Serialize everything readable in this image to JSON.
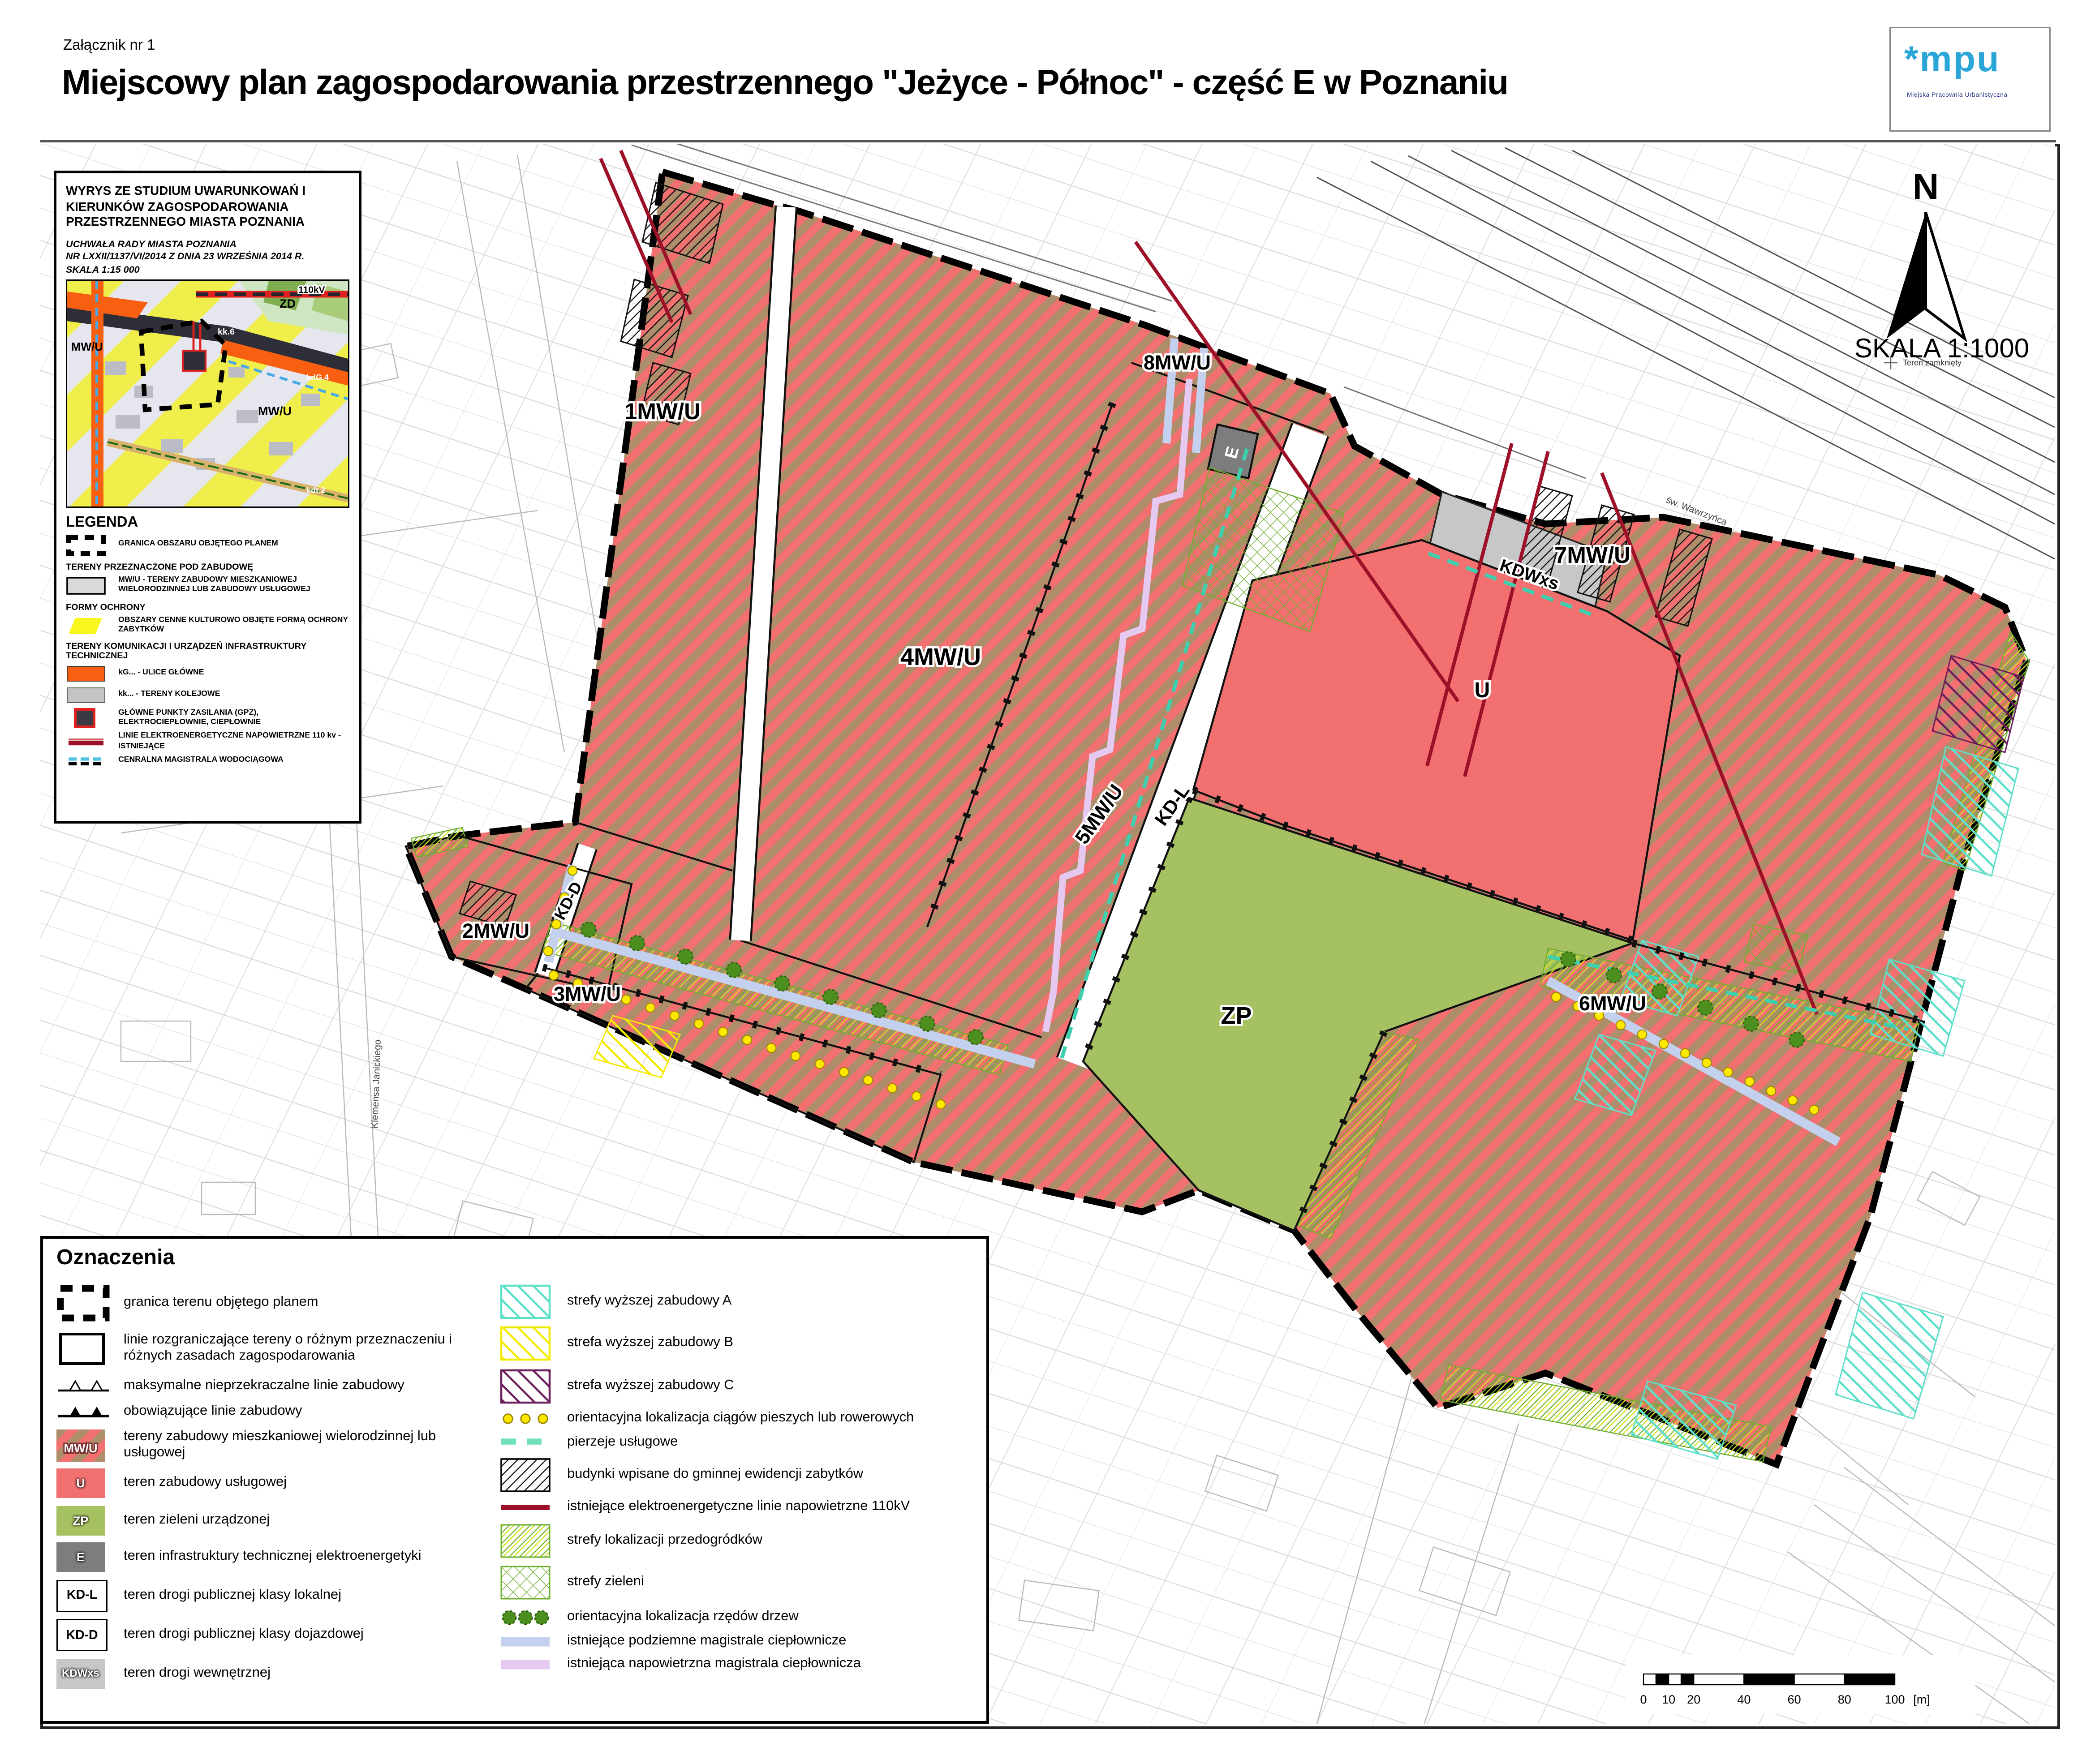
{
  "header": {
    "attachment": "Załącznik nr 1",
    "title": "Miejscowy plan zagospodarowania przestrzennego \"Jeżyce - Północ\" - część E  w Poznaniu",
    "logo": {
      "mark": "mpu",
      "star": "*",
      "subtitle": "Miejska Pracownia Urbanistyczna"
    }
  },
  "study_box": {
    "title": "WYRYS ZE STUDIUM UWARUNKOWAŃ I KIERUNKÓW  ZAGOSPODAROWANIA PRZESTRZENNEGO MIASTA POZNANIA",
    "res1": "UCHWAŁA RADY MIASTA POZNANIA",
    "res2": "NR LXXII/1137/VI/2014 Z DNIA 23 WRZEŚNIA 2014 R.",
    "res3": "SKALA 1:15 000",
    "legend_title": "LEGENDA",
    "e_granica": "GRANICA OBSZARU OBJĘTEGO PLANEM",
    "sec1": "TERENY PRZEZNACZONE POD ZABUDOWĘ",
    "e_mwu": "MW/U - TERENY ZABUDOWY MIESZKANIOWEJ WIELORODZINNEJ LUB ZABUDOWY USŁUGOWEJ",
    "sec2": "FORMY OCHRONY",
    "e_obszary": "OBSZARY CENNE KULTUROWO OBJĘTE FORMĄ OCHRONY ZABYTKÓW",
    "sec3": "TERENY KOMUNIKACJI I URZĄDZEŃ INFRASTRUKTURY TECHNICZNEJ",
    "e_kg": "kG...    - ULICE GŁÓWNE",
    "e_kk": "kk... - TERENY KOLEJOWE",
    "e_gpz": "GŁÓWNE PUNKTY ZASILANIA (GPZ), ELEKTROCIEPŁOWNIE, CIEPŁOWNIE",
    "e_linie": "LINIE  ELEKTROENERGETYCZNE NAPOWIETRZNE 110 kv - ISTNIEJĄCE",
    "e_magistrala": "CENRALNA MAGISTRALA WODOCIĄGOWA",
    "minimap": {
      "mwu_left": "MW/U",
      "mwu_right": "MW/U",
      "zd": "ZD",
      "kv": "110kV",
      "kk": "kk.6",
      "kdg": "kdG.4",
      "kdt": "kdt.2"
    }
  },
  "compass": {
    "letter": "N",
    "scale": "SKALA 1:1000",
    "teren": "Teren zamknięty"
  },
  "map": {
    "zones": {
      "z1": "1MW/U",
      "z2": "2MW/U",
      "z3": "3MW/U",
      "z4": "4MW/U",
      "z5": "5MW/U",
      "z6": "6MW/U",
      "z7": "7MW/U",
      "z8": "8MW/U",
      "u": "U",
      "zp": "ZP",
      "e": "E",
      "kdl": "KD-L",
      "kdd": "KD-D",
      "kdwxs": "KDWxs"
    },
    "bg_labels": {
      "street_top": "św. Wawrzyńca",
      "street_left": "Klemensa Janickiego"
    }
  },
  "oznaczenia": {
    "title": "Oznaczenia",
    "col1": [
      {
        "label": "granica terenu objętego planem"
      },
      {
        "label": "linie rozgraniczające tereny o różnym przeznaczeniu i różnych zasadach zagospodarowania"
      },
      {
        "label": "maksymalne nieprzekraczalne linie zabudowy"
      },
      {
        "label": "obowiązujące linie zabudowy"
      },
      {
        "tag": "MW/U",
        "label": "tereny zabudowy mieszkaniowej wielorodzinnej lub usługowej"
      },
      {
        "tag": "U",
        "label": "teren zabudowy usługowej"
      },
      {
        "tag": "ZP",
        "label": "teren zieleni urządzonej"
      },
      {
        "tag": "E",
        "label": "teren infrastruktury technicznej elektroenergetyki"
      },
      {
        "tag": "KD-L",
        "label": "teren drogi publicznej klasy lokalnej"
      },
      {
        "tag": "KD-D",
        "label": "teren drogi publicznej klasy dojazdowej"
      },
      {
        "tag": "KDWxs",
        "label": "teren drogi wewnętrznej"
      }
    ],
    "col2": [
      {
        "label": "strefy wyższej zabudowy A"
      },
      {
        "label": "strefa wyższej zabudowy B"
      },
      {
        "label": "strefa wyższej zabudowy C"
      },
      {
        "label": "orientacyjna lokalizacja ciągów pieszych lub rowerowych"
      },
      {
        "label": "pierzeje usługowe"
      },
      {
        "label": "budynki wpisane do gminnej ewidencji zabytków"
      },
      {
        "label": "istniejące elektroenergetyczne linie napowietrzne 110kV"
      },
      {
        "label": "strefy lokalizacji przedogródków"
      },
      {
        "label": "strefy zieleni"
      },
      {
        "label": "orientacyjna lokalizacja rzędów drzew"
      },
      {
        "label": "istniejące podziemne magistrale ciepłownicze"
      },
      {
        "label": "istniejąca napowietrzna magistrala ciepłownicza"
      }
    ]
  },
  "scalebar": {
    "ticks": [
      "0",
      "10",
      "20",
      "40",
      "60",
      "80",
      "100"
    ],
    "unit": "[m]"
  },
  "colors": {
    "mwu_red": "#f27070",
    "mwu_tan": "#ae8d6a",
    "zp_green": "#a6c162",
    "e_gray": "#7d7d7d",
    "kdw_gray": "#c7c7c7",
    "kv_red": "#9c1128",
    "cyan_a": "#5fe0cb",
    "yellow_b": "#f2ea00",
    "purple_c": "#6d1f5c",
    "green_hatch": "#6fae2e",
    "dot_yellow": "#ffe800",
    "tree_green": "#4d8f1f",
    "underground": "#c3d0ee",
    "overhead": "#e6c9f0",
    "teal_dash": "#3ed0ae",
    "orange_kg": "#f95f10"
  }
}
